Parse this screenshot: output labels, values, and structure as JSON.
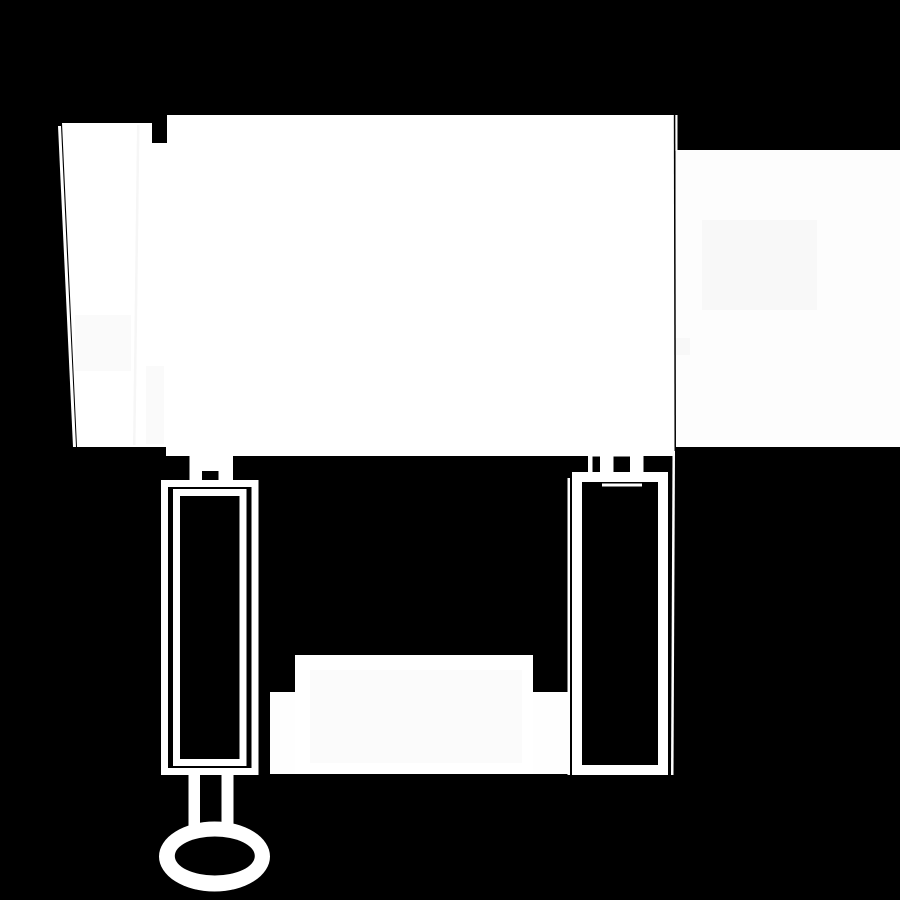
{
  "canvas": {
    "width": 900,
    "height": 900,
    "background_color": "#000000",
    "foreground_color": "#ffffff"
  },
  "shapes": [
    {
      "name": "wall-panel",
      "type": "polygon",
      "fill": "#ffffff",
      "points": [
        [
          62,
          123
        ],
        [
          152,
          123
        ],
        [
          152,
          143
        ],
        [
          167,
          143
        ],
        [
          167,
          115
        ],
        [
          675,
          115
        ],
        [
          675,
          456
        ],
        [
          166,
          456
        ],
        [
          166,
          447
        ],
        [
          77,
          447
        ]
      ]
    },
    {
      "name": "panel-left-edge-line",
      "type": "polygon",
      "fill": "#ffffff",
      "points": [
        [
          58,
          126
        ],
        [
          61,
          126
        ],
        [
          76,
          447
        ],
        [
          73,
          447
        ]
      ]
    },
    {
      "name": "panel-seam-line",
      "type": "polygon",
      "fill": "#f6f6f6",
      "points": [
        [
          137,
          125
        ],
        [
          139.5,
          125
        ],
        [
          135.5,
          445
        ],
        [
          133,
          445
        ]
      ]
    },
    {
      "name": "panel-shade-patch",
      "type": "rect",
      "fill": "#fafafa",
      "x": 75,
      "y": 315,
      "w": 56,
      "h": 56
    },
    {
      "name": "panel-shade-column",
      "type": "rect",
      "fill": "#fafafa",
      "x": 146,
      "y": 366,
      "w": 18,
      "h": 78
    },
    {
      "name": "wall-sliver-top",
      "type": "rect",
      "fill": "#fdfdfd",
      "x": 675,
      "y": 115,
      "w": 2.5,
      "h": 36
    },
    {
      "name": "right-wall",
      "type": "rect",
      "fill": "#fdfdfd",
      "x": 675.5,
      "y": 150,
      "w": 224.5,
      "h": 297
    },
    {
      "name": "wall-shade-patch-1",
      "type": "rect",
      "fill": "#f8f8f8",
      "x": 702,
      "y": 220,
      "w": 115,
      "h": 90
    },
    {
      "name": "wall-shade-patch-2",
      "type": "rect",
      "fill": "#f8f8f8",
      "x": 675.5,
      "y": 338,
      "w": 14.5,
      "h": 17
    },
    {
      "name": "panel-wall-gap-line",
      "type": "polygon",
      "fill": "#000000",
      "points": [
        [
          673.8,
          115
        ],
        [
          675.3,
          115
        ],
        [
          676,
          451
        ],
        [
          674.5,
          451
        ]
      ]
    },
    {
      "name": "left-post-neck",
      "type": "rect",
      "fill": "#ffffff",
      "x": 189.5,
      "y": 455,
      "w": 43.5,
      "h": 26
    },
    {
      "name": "left-post-neck-notch",
      "type": "rect",
      "fill": "#000000",
      "x": 202,
      "y": 471,
      "w": 16.5,
      "h": 10
    },
    {
      "name": "left-post-outer-frame",
      "type": "frame",
      "stroke": "#ffffff",
      "sw": 7,
      "x": 161,
      "y": 480,
      "w": 97.5,
      "h": 295
    },
    {
      "name": "left-post-inner-frame",
      "type": "frame",
      "stroke": "#ffffff",
      "sw": 7,
      "x": 173,
      "y": 489,
      "w": 73.5,
      "h": 277
    },
    {
      "name": "right-post-neck",
      "type": "rect",
      "fill": "#ffffff",
      "x": 588,
      "y": 455,
      "w": 55.5,
      "h": 17.5
    },
    {
      "name": "right-post-neck-notch-1",
      "type": "rect",
      "fill": "#000000",
      "x": 592.5,
      "y": 456.5,
      "w": 7.5,
      "h": 16
    },
    {
      "name": "right-post-neck-notch-2",
      "type": "rect",
      "fill": "#000000",
      "x": 613.5,
      "y": 456.5,
      "w": 16.5,
      "h": 16
    },
    {
      "name": "right-post-frame",
      "type": "frame",
      "stroke": "#ffffff",
      "sw": 10,
      "x": 572,
      "y": 472,
      "w": 96,
      "h": 303
    },
    {
      "name": "right-post-inner-top-line",
      "type": "rect",
      "fill": "#ffffff",
      "x": 602,
      "y": 483.5,
      "w": 40,
      "h": 3
    },
    {
      "name": "right-post-left-sliver",
      "type": "rect",
      "fill": "#fdfdfd",
      "x": 567.5,
      "y": 478,
      "w": 2.5,
      "h": 297
    },
    {
      "name": "right-post-right-sliver",
      "type": "polygon",
      "fill": "#fdfdfd",
      "points": [
        [
          672.5,
          451
        ],
        [
          675,
          451
        ],
        [
          673.5,
          775
        ],
        [
          671,
          775
        ]
      ]
    },
    {
      "name": "bench-main",
      "type": "rect",
      "fill": "#ffffff",
      "x": 295,
      "y": 655,
      "w": 238,
      "h": 119
    },
    {
      "name": "bench-inner-shade",
      "type": "rect",
      "fill": "#fbfbfb",
      "x": 310,
      "y": 670,
      "w": 212,
      "h": 93
    },
    {
      "name": "bench-left-foot",
      "type": "rect",
      "fill": "#fefefe",
      "x": 270,
      "y": 692,
      "w": 25,
      "h": 82
    },
    {
      "name": "bench-right-foot",
      "type": "rect",
      "fill": "#fefefe",
      "x": 533,
      "y": 692,
      "w": 37,
      "h": 82
    },
    {
      "name": "stem-left-bar",
      "type": "rect",
      "fill": "#ffffff",
      "x": 188.5,
      "y": 774,
      "w": 11.5,
      "h": 53
    },
    {
      "name": "stem-right-bar",
      "type": "rect",
      "fill": "#ffffff",
      "x": 221.5,
      "y": 774,
      "w": 12,
      "h": 53
    },
    {
      "name": "ring-outer",
      "type": "ellipse",
      "fill": "#ffffff",
      "cx": 214.5,
      "cy": 856.5,
      "rx": 55.5,
      "ry": 35
    },
    {
      "name": "ring-hole",
      "type": "ellipse",
      "fill": "#000000",
      "cx": 214.8,
      "cy": 856,
      "rx": 40,
      "ry": 19.5
    }
  ]
}
